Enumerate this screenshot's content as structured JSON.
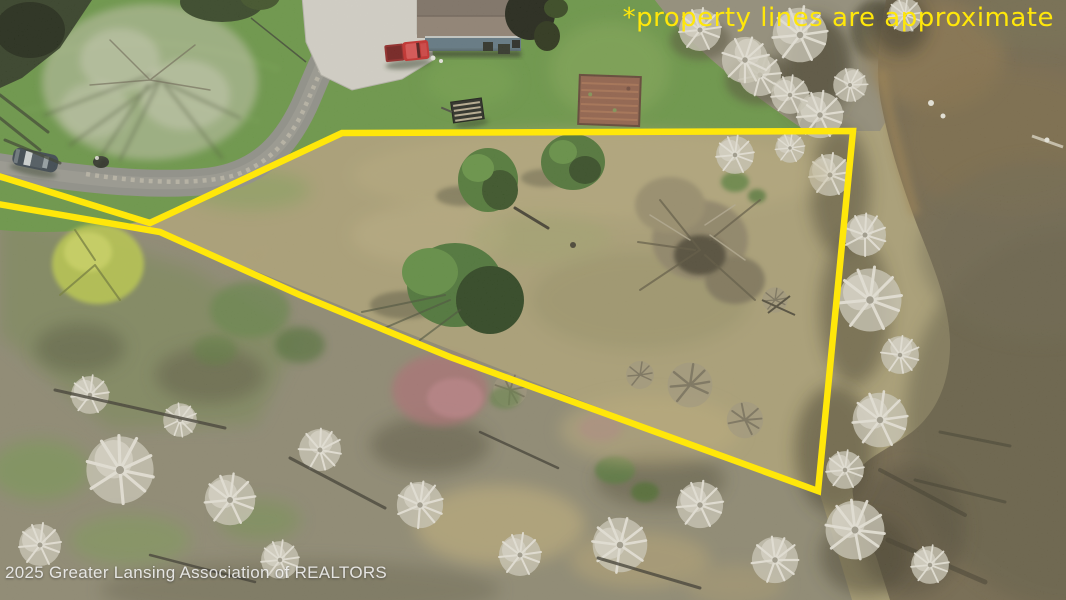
{
  "annotation": {
    "text": "*property lines are approximate",
    "color": "#ffe70a"
  },
  "watermark": {
    "text": "2025 Greater Lansing Association of REALTORS"
  },
  "boundary": {
    "points": "-8,174 150,223 342,133 853,131 818,491 450,357 300,295 160,232 -8,203",
    "color": "#ffe70a",
    "width": "6.5"
  },
  "palette": {
    "line_yellow": "#ffe70a",
    "lawn_green": "#649340",
    "field_tan": "#a89b6e",
    "woodland_gray": "#85806a",
    "river_brown": "#6e6248",
    "bank_tree_gray": "#cbc7b7",
    "road_gray": "#8c8c86",
    "concrete": "#d3d1c8",
    "roof_gray": "#84766a",
    "house_wall_blue": "#5a7280",
    "truck_red": "#c32424"
  }
}
